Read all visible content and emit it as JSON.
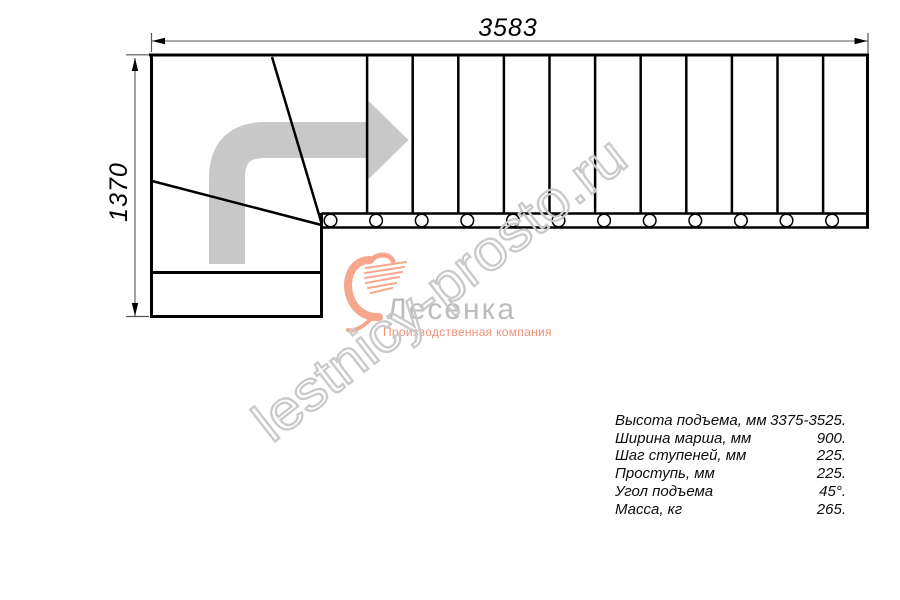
{
  "dimensions": {
    "top_width_mm": "3583",
    "left_depth_mm": "1370"
  },
  "spec_table": {
    "rows": [
      {
        "label": "Высота подъема, мм",
        "value": "3375-3525."
      },
      {
        "label": "Ширина марша, мм",
        "value": "900."
      },
      {
        "label": "Шаг ступеней, мм",
        "value": "225."
      },
      {
        "label": "Проступь, мм",
        "value": "225."
      },
      {
        "label": "Угол подъема",
        "value": "45°."
      },
      {
        "label": "Масса, кг",
        "value": "265."
      }
    ]
  },
  "logo": {
    "name": "Лесенка",
    "tagline": "Производственная компания"
  },
  "watermark": {
    "text": "lestnicy-prosto.ru"
  },
  "drawing": {
    "straight_treads": 12,
    "balusters": 12,
    "winder_treads": 3
  },
  "colors": {
    "line": "#000000",
    "dimension": "#555555",
    "arrow_gray": "#c8c8c8",
    "watermark_gray": "#c9c9c9",
    "logo_text_gray": "#bcbcbc",
    "logo_salmon": "#f5a68c",
    "tagline_salmon": "#ef9078"
  }
}
